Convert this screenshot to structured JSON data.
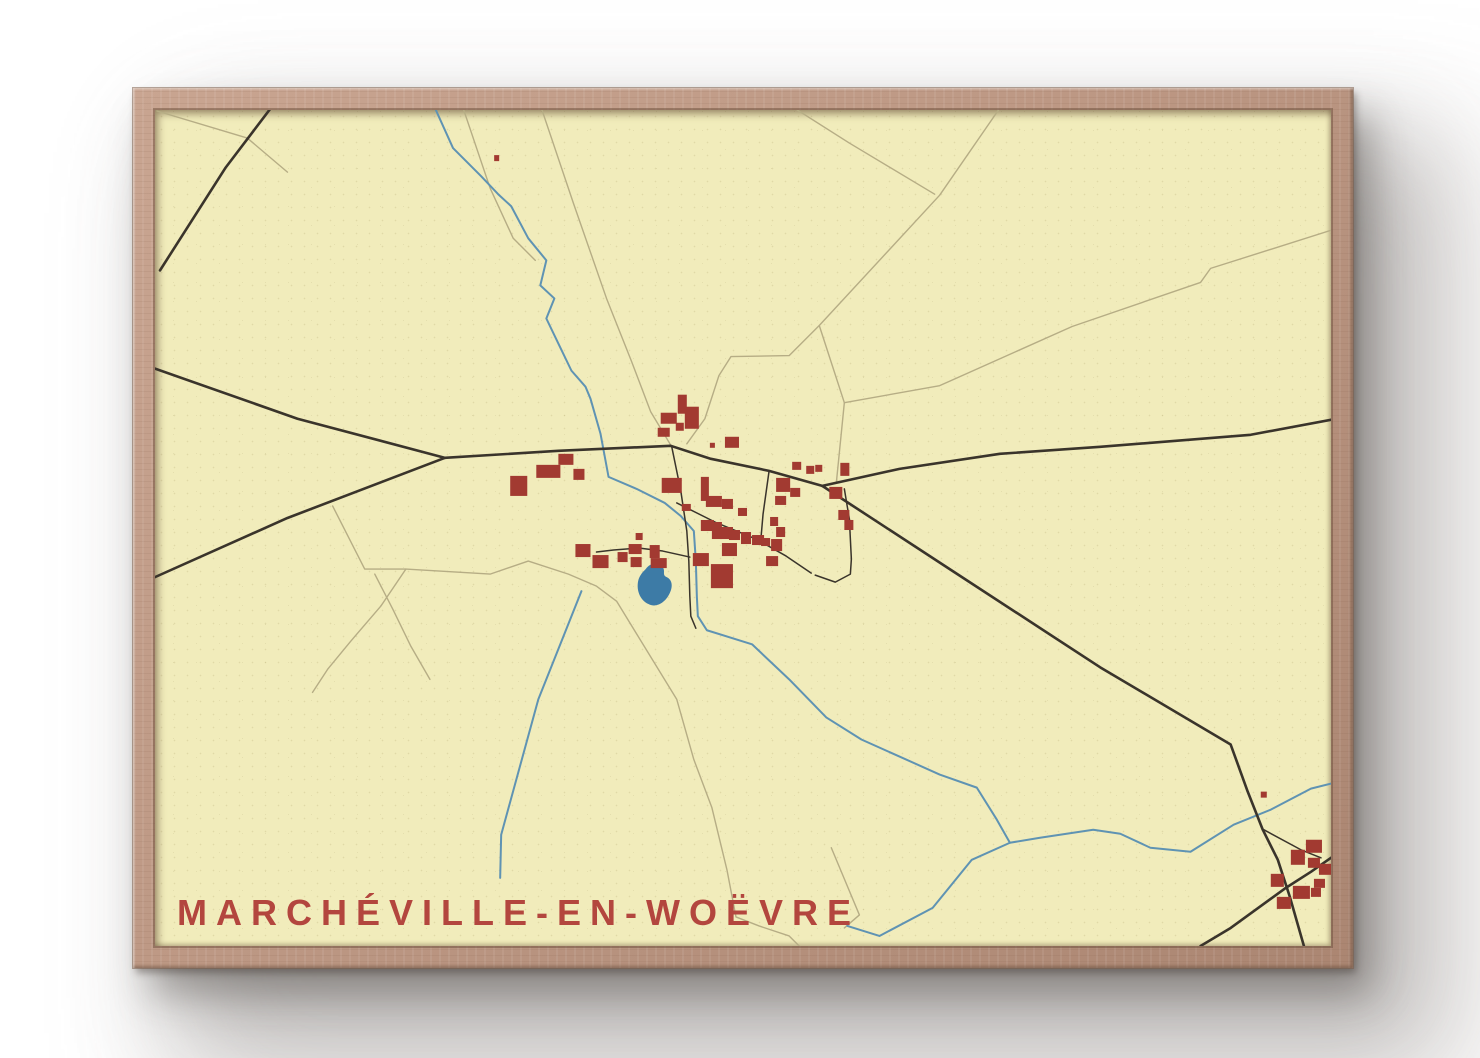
{
  "poster": {
    "title": "MARCHÉVILLE-EN-WOËVRE",
    "colors": {
      "paper": "#f1ecbb",
      "road_major": "#3a342b",
      "road_minor": "#b6ad85",
      "water": "#5f93b3",
      "pond": "#3d7ba6",
      "building": "#a23a31",
      "title_text": "#b3463e",
      "frame_wood": "#bd9884"
    }
  },
  "map": {
    "width": 1172,
    "height": 834,
    "layers": [
      {
        "name": "minor-roads",
        "kind": "polyline",
        "stroke": "#b6ad85",
        "width": 1.4,
        "paths": [
          "307,-2 334,78 357,128 379,150",
          "385,-2 417,93 450,188 475,251 494,301 515,336",
          "637,-2 692,33 777,84",
          "530,333 548,308 562,265 574,246 632,245 662,215 782,85 842,-2",
          "662,215 675,255 687,292",
          "687,292 782,275 914,216 1042,172 1052,158 1172,120",
          "687,292 679,372",
          "2,1 92,28 132,62",
          "177,395 209,458 250,458 334,463 372,450 412,463 440,475 460,490 520,588 537,648 555,696 570,758 579,805 602,814 632,824 642,834",
          "250,458 225,495 195,530 172,558 157,581",
          "219,463 237,498 255,535 274,568",
          "674,736 702,803 687,816"
        ]
      },
      {
        "name": "streams",
        "kind": "polyline",
        "stroke": "#5f93b3",
        "width": 2,
        "paths": [
          "279,-2 297,38 325,66 342,84 355,96 372,128 390,150 384,175 398,188 390,208 402,233 415,260 429,276 434,288 444,323 452,366 480,378 508,392 524,405 537,420 539,450 540,485 541,505 550,519 595,533 632,568 669,606 704,628 742,645 782,663 819,676 839,708 852,731 882,726 935,718 962,722 992,736 1032,740 1075,713 1112,698 1152,677 1172,672",
          "852,731 814,748 775,796 722,824 690,814",
          "425,480 382,588 345,723 344,766"
        ]
      },
      {
        "name": "pond",
        "kind": "path",
        "fill": "#3d7ba6",
        "d": "M489,458 C494,451 502,451 506,456 C509,460 505,464 510,466 C516,469 516,476 513,482 C509,491 500,497 492,493 C483,489 479,478 482,468 C484,463 486,461 489,458 Z"
      },
      {
        "name": "major-roads",
        "kind": "polyline",
        "stroke": "#3a342b",
        "width": 2.6,
        "paths": [
          "117,-4 70,58 5,160",
          "0,258 142,308 289,347",
          "0,466 132,407 289,347",
          "289,347 402,340 514,335 554,348 612,360 665,375",
          "665,375 742,358 842,343 942,336 1092,324 1172,309",
          "665,375 792,458 942,556 1072,633 1089,680 1104,718 1119,748 1131,785 1145,834",
          "1042,834 1072,816 1127,776 1152,760 1172,746"
        ]
      },
      {
        "name": "village-streets",
        "kind": "polyline",
        "stroke": "#3a342b",
        "width": 1.5,
        "paths": [
          "515,336 524,380 530,420 532,450 533,485 534,505 539,517",
          "520,392 560,412 599,428 629,445 654,462",
          "612,360 606,403 604,426",
          "687,378 692,408 694,448 693,463 678,471 658,464",
          "533,446 506,440 482,437 457,439 440,441",
          "1105,718 1142,738 1162,746"
        ]
      },
      {
        "name": "buildings",
        "kind": "rects",
        "fill": "#a23a31",
        "rects": [
          [
            504,
            302,
            16,
            11
          ],
          [
            521,
            284,
            9,
            19
          ],
          [
            528,
            296,
            14,
            22
          ],
          [
            501,
            317,
            12,
            9
          ],
          [
            519,
            312,
            8,
            8
          ],
          [
            568,
            326,
            14,
            11
          ],
          [
            354,
            365,
            17,
            20
          ],
          [
            380,
            354,
            24,
            13
          ],
          [
            402,
            343,
            15,
            11
          ],
          [
            417,
            358,
            11,
            11
          ],
          [
            505,
            367,
            20,
            15
          ],
          [
            544,
            366,
            8,
            24
          ],
          [
            549,
            385,
            16,
            11
          ],
          [
            565,
            388,
            11,
            10
          ],
          [
            581,
            397,
            9,
            8
          ],
          [
            525,
            393,
            9,
            7
          ],
          [
            544,
            409,
            13,
            11
          ],
          [
            555,
            411,
            10,
            17
          ],
          [
            563,
            416,
            13,
            12
          ],
          [
            572,
            419,
            11,
            10
          ],
          [
            584,
            421,
            10,
            12
          ],
          [
            595,
            424,
            12,
            10
          ],
          [
            604,
            427,
            9,
            8
          ],
          [
            565,
            432,
            15,
            13
          ],
          [
            554,
            453,
            22,
            24
          ],
          [
            613,
            406,
            8,
            9
          ],
          [
            619,
            416,
            9,
            10
          ],
          [
            614,
            428,
            11,
            12
          ],
          [
            609,
            445,
            12,
            10
          ],
          [
            619,
            367,
            14,
            14
          ],
          [
            633,
            377,
            10,
            9
          ],
          [
            635,
            351,
            9,
            8
          ],
          [
            649,
            355,
            8,
            8
          ],
          [
            658,
            354,
            7,
            7
          ],
          [
            618,
            385,
            11,
            9
          ],
          [
            672,
            376,
            13,
            12
          ],
          [
            683,
            352,
            9,
            13
          ],
          [
            681,
            399,
            11,
            10
          ],
          [
            687,
            409,
            9,
            10
          ],
          [
            472,
            433,
            13,
            10
          ],
          [
            461,
            441,
            10,
            10
          ],
          [
            474,
            446,
            11,
            10
          ],
          [
            493,
            434,
            10,
            13
          ],
          [
            494,
            447,
            16,
            10
          ],
          [
            536,
            442,
            16,
            13
          ],
          [
            419,
            433,
            15,
            13
          ],
          [
            436,
            444,
            16,
            13
          ],
          [
            479,
            422,
            7,
            7
          ],
          [
            1147,
            728,
            16,
            13
          ],
          [
            1132,
            738,
            14,
            15
          ],
          [
            1149,
            746,
            12,
            10
          ],
          [
            1160,
            752,
            12,
            11
          ],
          [
            1112,
            762,
            13,
            13
          ],
          [
            1134,
            774,
            17,
            13
          ],
          [
            1118,
            785,
            14,
            12
          ],
          [
            1152,
            776,
            10,
            9
          ],
          [
            1155,
            767,
            11,
            9
          ],
          [
            1102,
            680,
            6,
            6
          ],
          [
            338,
            45,
            5,
            6
          ],
          [
            553,
            332,
            5,
            5
          ]
        ]
      }
    ]
  }
}
